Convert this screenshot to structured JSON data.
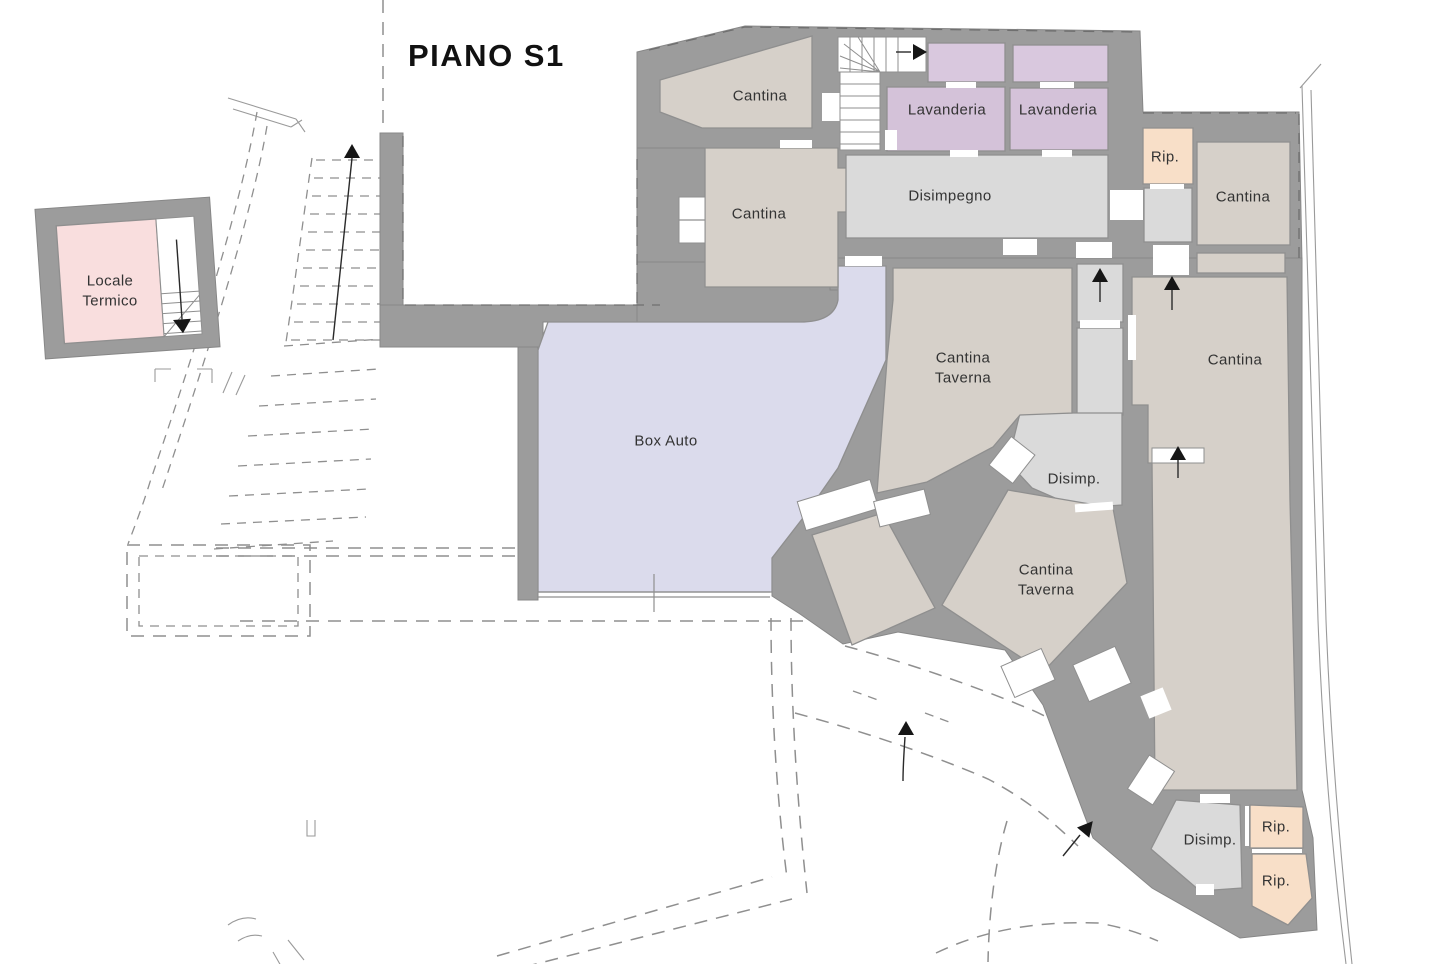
{
  "floor_plan": {
    "title": "PIANO S1",
    "labels": {
      "cantina_top": "Cantina",
      "cantina_mid": "Cantina",
      "lavanderia_left": "Lavanderia",
      "lavanderia_right": "Lavanderia",
      "disimpegno": "Disimpegno",
      "rip_top": "Rip.",
      "cantina_top_right": "Cantina",
      "locale_termico_line1": "Locale",
      "locale_termico_line2": "Termico",
      "cantina_taverna_1_line1": "Cantina",
      "cantina_taverna_1_line2": "Taverna",
      "box_auto": "Box Auto",
      "cantina_right": "Cantina",
      "disimp_center": "Disimp.",
      "cantina_taverna_2_line1": "Cantina",
      "cantina_taverna_2_line2": "Taverna",
      "disimp_bottom": "Disimp.",
      "rip_bottom_1": "Rip.",
      "rip_bottom_2": "Rip."
    },
    "colors": {
      "wall": "#9c9c9c",
      "room_beige": "#d6d0c9",
      "room_gray": "#dadada",
      "room_purple": "#d4c2d9",
      "room_peach": "#f8dfc8",
      "room_pink": "#f9dede",
      "room_blue": "#dbdbec",
      "line": "#8f8f8f",
      "arrow": "#161616"
    },
    "icons": {
      "stair_up_arrow": "▲",
      "stair_down_arrow": "▼",
      "stair_right_arrow": "▶"
    }
  }
}
